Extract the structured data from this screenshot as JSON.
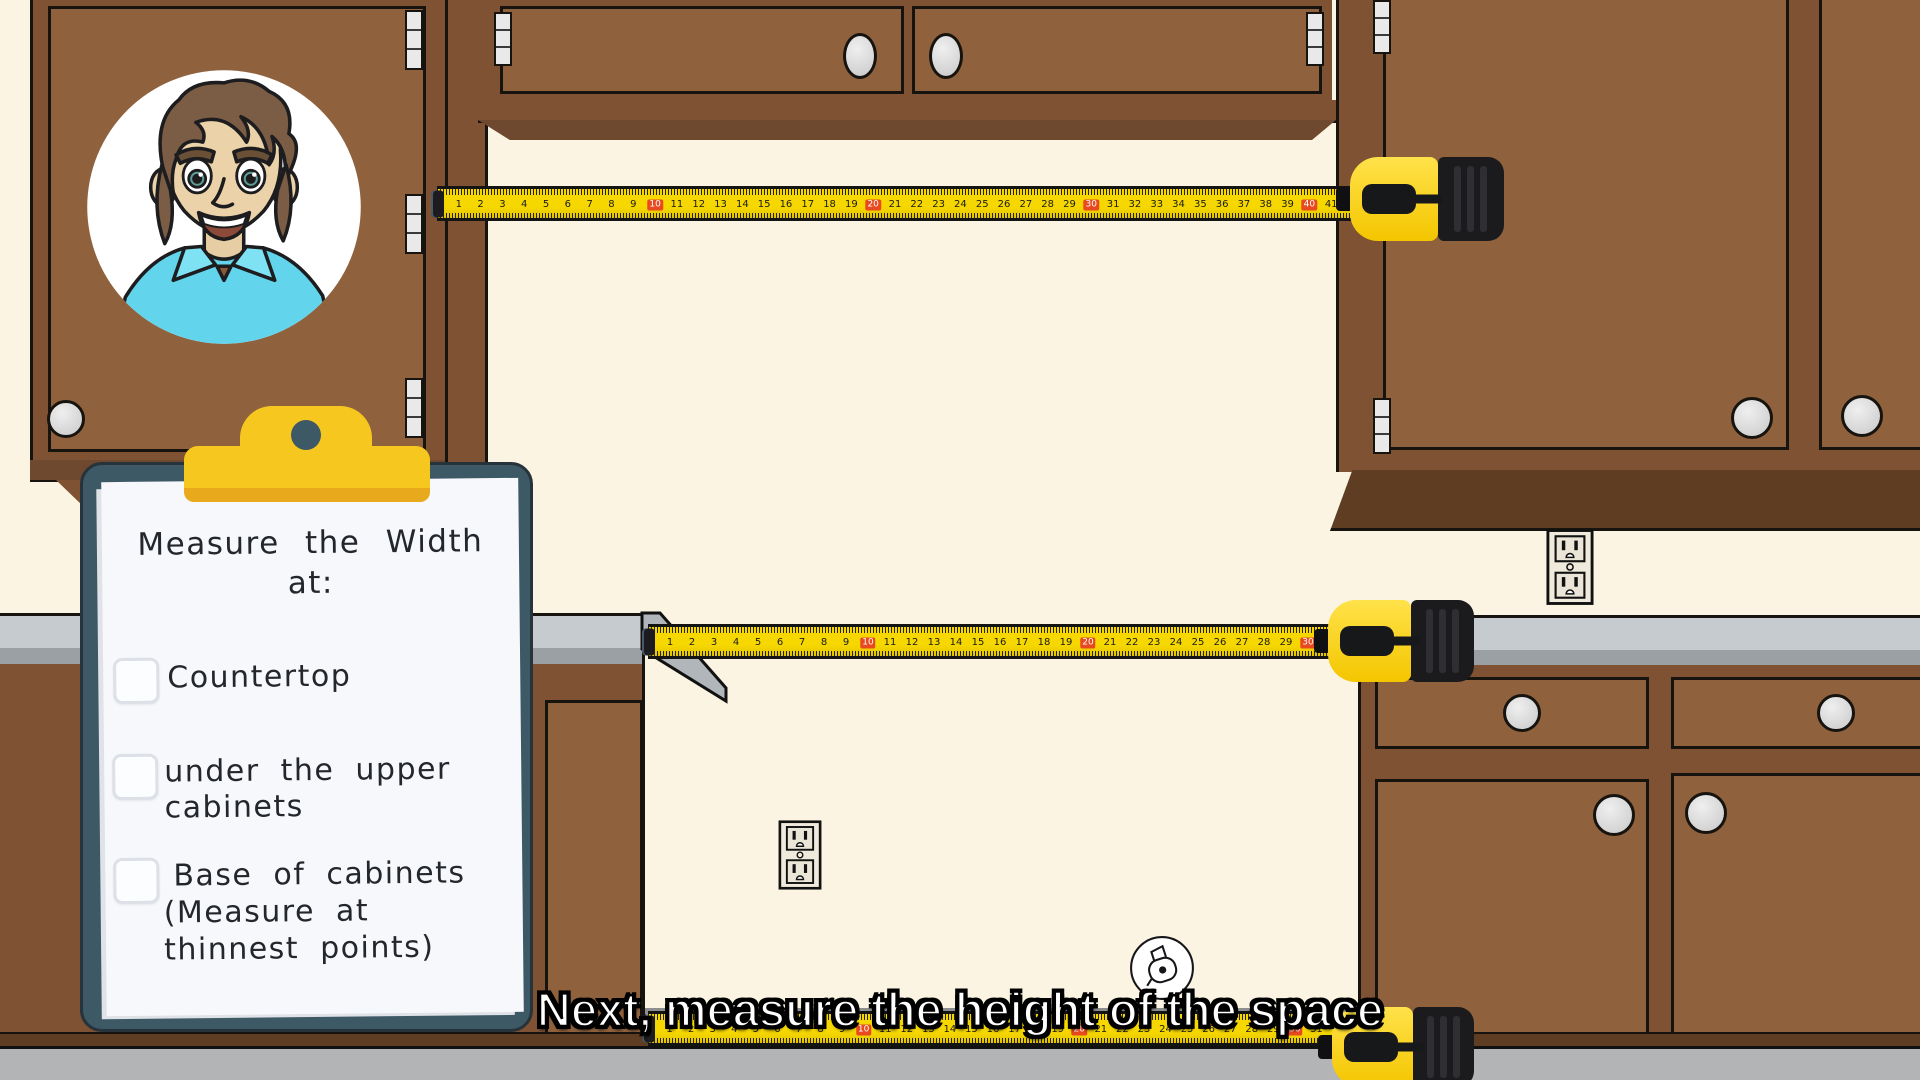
{
  "colors": {
    "wall": "#fbf4e2",
    "cabinet_frame": "#7e5233",
    "cabinet_door": "#8f613c",
    "cabinet_dark": "#5f3d22",
    "counter_light": "#c6cbcf",
    "counter_dark": "#9aa0a4",
    "counter_side": "#b0b6ba",
    "floor": "#b2b4b5",
    "floor_recess": "#8c8e8f",
    "board": "#3d5966",
    "paper": "#f7f8fb",
    "clip_yellow": "#f5c71f",
    "clip_yellow_dark": "#e9a91c",
    "tape_yellow": "#f6d800",
    "tape_mark_red": "#e8491f",
    "outlet": "#efeadb",
    "checkbox_border": "#dde0e6",
    "ink": "#23272c",
    "caption_fill": "#ffffff",
    "caption_outline": "#000000"
  },
  "caption": {
    "text": "Next, measure the height of the space"
  },
  "clipboard": {
    "title_lines": [
      "Measure the Width",
      "at:"
    ],
    "items": [
      {
        "lines": [
          "Countertop"
        ],
        "checked": false
      },
      {
        "lines": [
          "under the upper",
          "cabinets"
        ],
        "checked": false
      },
      {
        "lines": [
          "Base of cabinets",
          "(Measure at",
          "thinnest points)"
        ],
        "checked": false
      }
    ]
  },
  "tapes": {
    "top": {
      "numbers": [
        1,
        2,
        3,
        4,
        5,
        6,
        7,
        8,
        9,
        10,
        11,
        12,
        13,
        14,
        15,
        16,
        17,
        18,
        19,
        20,
        21,
        22,
        23,
        24,
        25,
        26,
        27,
        28,
        29,
        30,
        31,
        32,
        33,
        34,
        35,
        36,
        37,
        38,
        39,
        40,
        41
      ],
      "highlight_every": 10
    },
    "middle": {
      "numbers": [
        1,
        2,
        3,
        4,
        5,
        6,
        7,
        8,
        9,
        10,
        11,
        12,
        13,
        14,
        15,
        16,
        17,
        18,
        19,
        20,
        21,
        22,
        23,
        24,
        25,
        26,
        27,
        28,
        29,
        30,
        31
      ],
      "highlight_every": 10
    },
    "bottom": {
      "numbers": [
        1,
        2,
        3,
        4,
        5,
        6,
        7,
        8,
        9,
        10,
        11,
        12,
        13,
        14,
        15,
        16,
        17,
        18,
        19,
        20,
        21,
        22,
        23,
        24,
        25,
        26,
        27,
        28,
        29,
        30,
        31
      ],
      "highlight_every": 10
    }
  }
}
